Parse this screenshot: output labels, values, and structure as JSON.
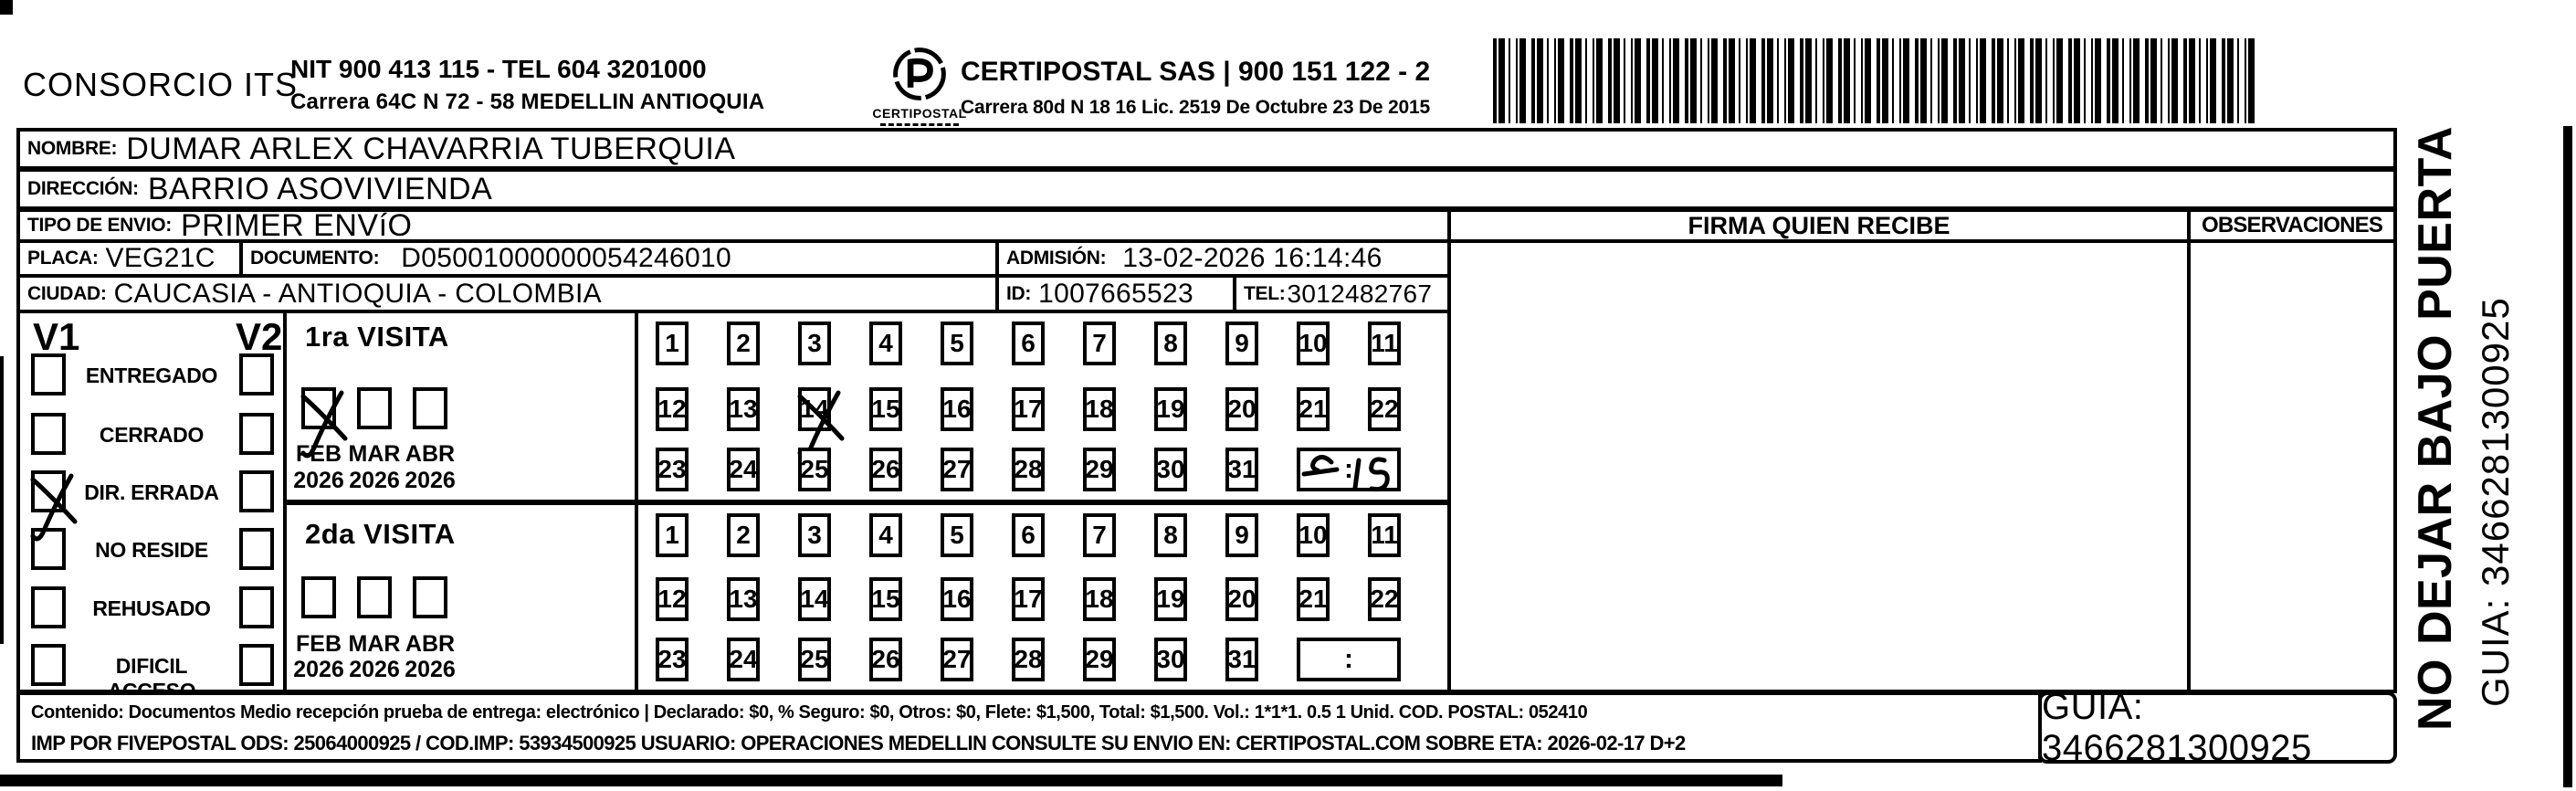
{
  "colors": {
    "ink": "#000000",
    "paper": "#ffffff"
  },
  "header": {
    "brand": "CONSORCIO ITS",
    "nit_line1": "NIT 900 413 115 - TEL 604 3201000",
    "nit_line2": "Carrera 64C N 72 - 58 MEDELLIN ANTIOQUIA",
    "logo_caption": "CERTIPOSTAL",
    "right_line1": "CERTIPOSTAL SAS | 900 151 122 - 2",
    "right_line2": "Carrera 80d N 18 16  Lic. 2519 De Octubre 23 De 2015",
    "barcode": "barcode-1d"
  },
  "shipment": {
    "nombre_label": "NOMBRE:",
    "nombre": "DUMAR ARLEX CHAVARRIA TUBERQUIA",
    "direccion_label": "DIRECCIÓN:",
    "direccion": "BARRIO ASOVIVIENDA",
    "tipo_label": "TIPO DE ENVIO:",
    "tipo": "PRIMER ENVíO",
    "placa_label": "PLACA:",
    "placa": "VEG21C",
    "documento_label": "DOCUMENTO:",
    "documento": "D05001000000054246010",
    "admision_label": "ADMISIÓN:",
    "admision": "13-02-2026 16:14:46",
    "ciudad_label": "CIUDAD:",
    "ciudad": "CAUCASIA - ANTIOQUIA - COLOMBIA",
    "id_label": "ID:",
    "id_value": "1007665523",
    "tel_label": "TEL:",
    "tel": "3012482767"
  },
  "signature": {
    "firma_header": "FIRMA QUIEN RECIBE",
    "observaciones_header": "OBSERVACIONES"
  },
  "status": {
    "v1_label": "V1",
    "v2_label": "V2",
    "options": [
      {
        "label": "ENTREGADO",
        "v1": false,
        "v2": false
      },
      {
        "label": "CERRADO",
        "v1": false,
        "v2": false
      },
      {
        "label": "DIR. ERRADA",
        "v1": true,
        "v2": false
      },
      {
        "label": "NO RESIDE",
        "v1": false,
        "v2": false
      },
      {
        "label": "REHUSADO",
        "v1": false,
        "v2": false
      },
      {
        "label": "DIFICIL ACCESO",
        "v1": false,
        "v2": false
      }
    ]
  },
  "visits": [
    {
      "title": "1ra VISITA",
      "months": [
        {
          "m": "FEB",
          "y": "2026",
          "checked": true
        },
        {
          "m": "MAR",
          "y": "2026",
          "checked": false
        },
        {
          "m": "ABR",
          "y": "2026",
          "checked": false
        }
      ],
      "rows": [
        [
          1,
          2,
          3,
          4,
          5,
          6,
          7,
          8,
          9,
          10,
          11
        ],
        [
          12,
          13,
          14,
          15,
          16,
          17,
          18,
          19,
          20,
          21,
          22
        ],
        [
          23,
          24,
          25,
          26,
          27,
          28,
          29,
          30,
          31
        ]
      ],
      "crossed_day": 14,
      "time_written": "7:15",
      "time_colon": ":"
    },
    {
      "title": "2da VISITA",
      "months": [
        {
          "m": "FEB",
          "y": "2026",
          "checked": false
        },
        {
          "m": "MAR",
          "y": "2026",
          "checked": false
        },
        {
          "m": "ABR",
          "y": "2026",
          "checked": false
        }
      ],
      "rows": [
        [
          1,
          2,
          3,
          4,
          5,
          6,
          7,
          8,
          9,
          10,
          11
        ],
        [
          12,
          13,
          14,
          15,
          16,
          17,
          18,
          19,
          20,
          21,
          22
        ],
        [
          23,
          24,
          25,
          26,
          27,
          28,
          29,
          30,
          31
        ]
      ],
      "crossed_day": null,
      "time_written": null,
      "time_colon": ":"
    }
  ],
  "footer": {
    "line1": "Contenido: Documentos Medio recepción prueba de entrega: electrónico | Declarado: $0, % Seguro: $0, Otros: $0, Flete: $1,500, Total: $1,500. Vol.: 1*1*1. 0.5  1 Unid. COD. POSTAL: 052410",
    "line2": "IMP POR FIVEPOSTAL ODS: 25064000925 / COD.IMP: 53934500925 USUARIO: OPERACIONES MEDELLIN CONSULTE SU ENVIO EN: CERTIPOSTAL.COM SOBRE ETA: 2026-02-17 D+2",
    "guia": "GUIA: 3466281300925"
  },
  "side": {
    "line1": "NO DEJAR BAJO PUERTA",
    "line2": "GUIA: 3466281300925"
  }
}
